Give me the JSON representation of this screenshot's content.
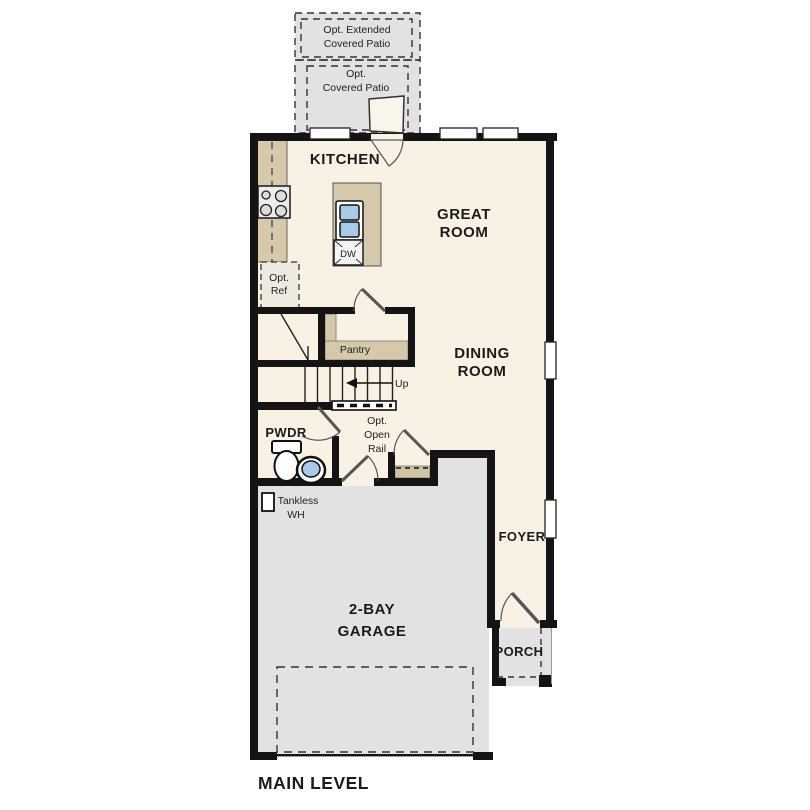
{
  "plan": {
    "title": "MAIN LEVEL",
    "rooms": {
      "kitchen": "KITCHEN",
      "great_room": [
        "GREAT",
        "ROOM"
      ],
      "dining_room": [
        "DINING",
        "ROOM"
      ],
      "powder": "PWDR",
      "pantry": "Pantry",
      "foyer": "FOYER",
      "porch": "PORCH",
      "garage": [
        "2-BAY",
        "GARAGE"
      ]
    },
    "options": {
      "extended_patio": [
        "Opt. Extended",
        "Covered Patio"
      ],
      "covered_patio": [
        "Opt.",
        "Covered Patio"
      ],
      "refrigerator": [
        "Opt.",
        "Ref"
      ],
      "open_rail": [
        "Opt.",
        "Open",
        "Rail"
      ]
    },
    "fixtures": {
      "dishwasher": "DW",
      "tankless_water_heater": [
        "Tankless",
        "WH"
      ],
      "stairs_direction": "Up"
    },
    "colors": {
      "wall": "#141414",
      "floor": "#f8f1e4",
      "concrete": "#e2e2e2",
      "cabinet": "#d5c8ab",
      "sink_blue": "#a9c9e9"
    }
  }
}
